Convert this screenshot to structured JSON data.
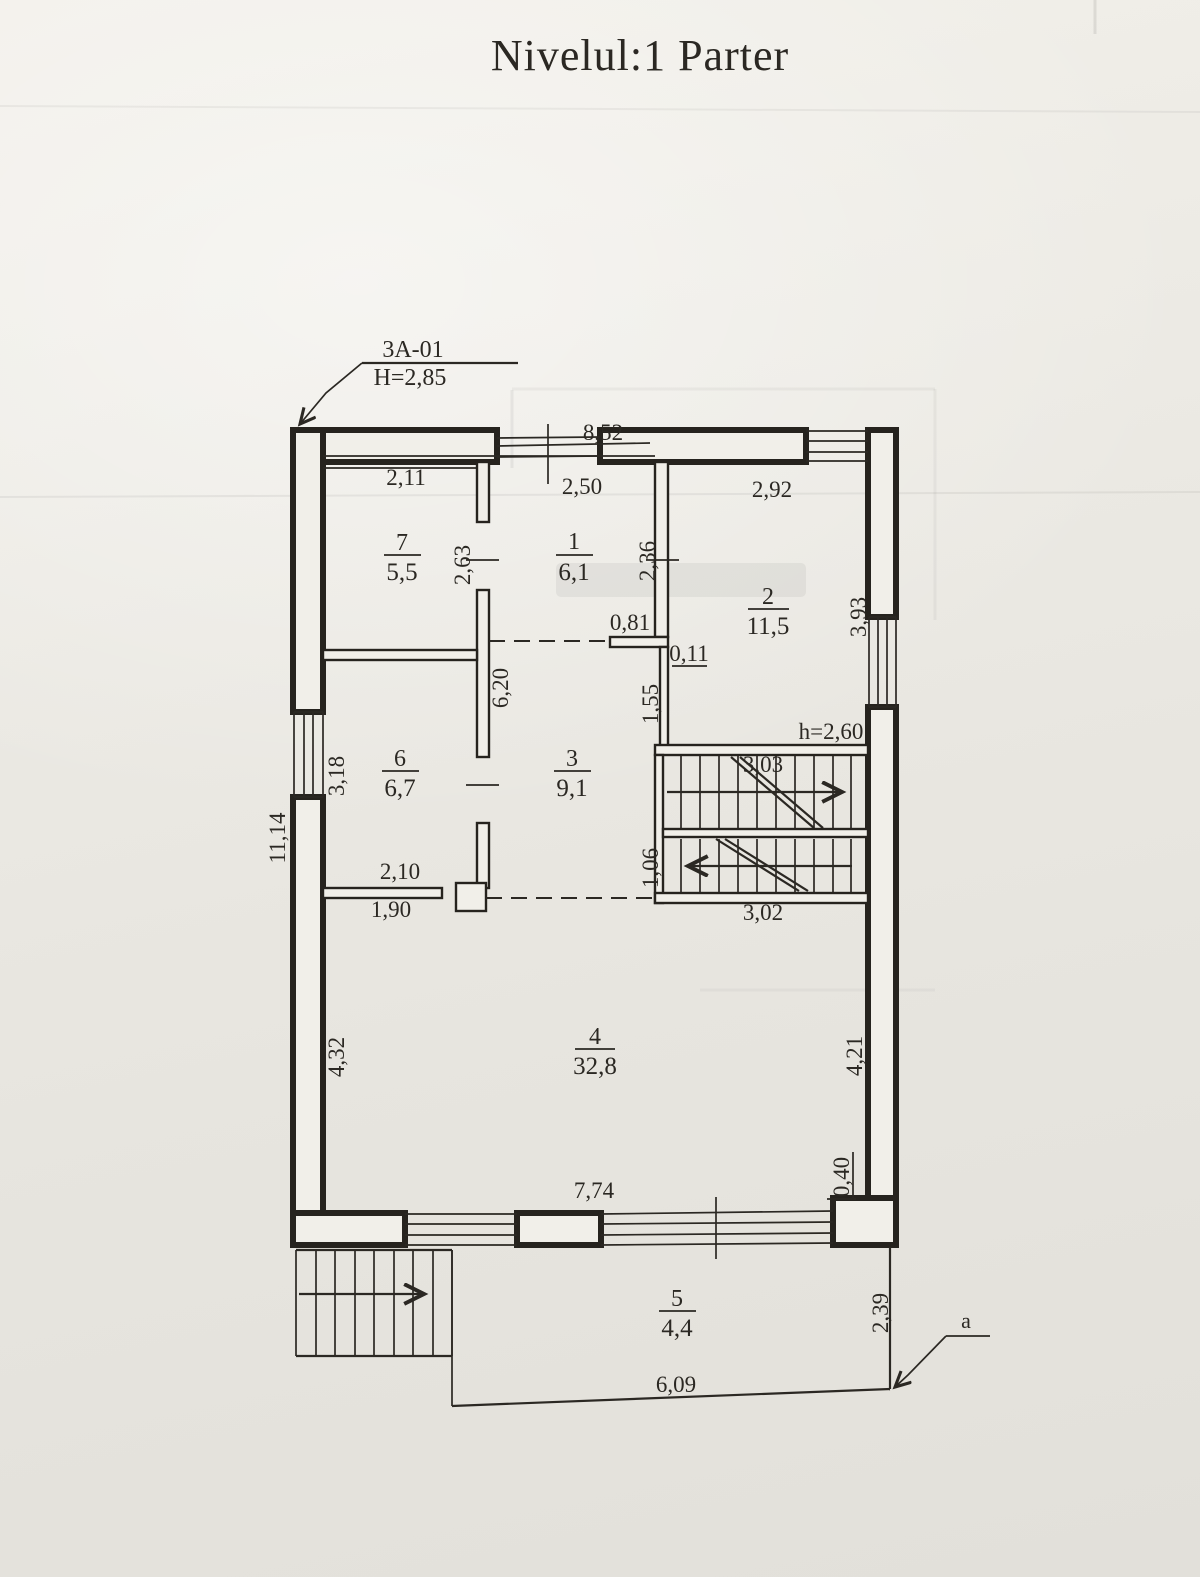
{
  "title": "Nivelul:1 Parter",
  "leader": {
    "code": "3A-01",
    "height_label": "H=2,85"
  },
  "corner_ref": {
    "label": "a"
  },
  "rooms": [
    {
      "num": "7",
      "area": "5,5"
    },
    {
      "num": "1",
      "area": "6,1"
    },
    {
      "num": "2",
      "area": "11,5"
    },
    {
      "num": "6",
      "area": "6,7"
    },
    {
      "num": "3",
      "area": "9,1"
    },
    {
      "num": "4",
      "area": "32,8"
    },
    {
      "num": "5",
      "area": "4,4"
    }
  ],
  "dims": {
    "overall_top": "8,52",
    "room7_width": "2,11",
    "room1_width": "2,50",
    "room2_width": "2,92",
    "room7_depth": "2,63",
    "room1_depth": "2,36",
    "niche_width": "0,81",
    "wall_thickness": "0,11",
    "hall_length": "6,20",
    "wall_below_niche": "1,55",
    "room6_depth": "3,18",
    "window_right": "3,93",
    "stair_up_length": "3,03",
    "stair_height_note": "h=2,60",
    "room6_width_top": "2,10",
    "room6_width_bottom": "1,90",
    "stair_lower_width": "1,06",
    "stair_down_length": "3,02",
    "left_overall": "11,14",
    "room4_left_depth": "4,32",
    "room4_right_depth": "4,21",
    "corner_offset": "0,40",
    "room4_width": "7,74",
    "terrace_width": "6,09",
    "terrace_depth": "2,39"
  }
}
